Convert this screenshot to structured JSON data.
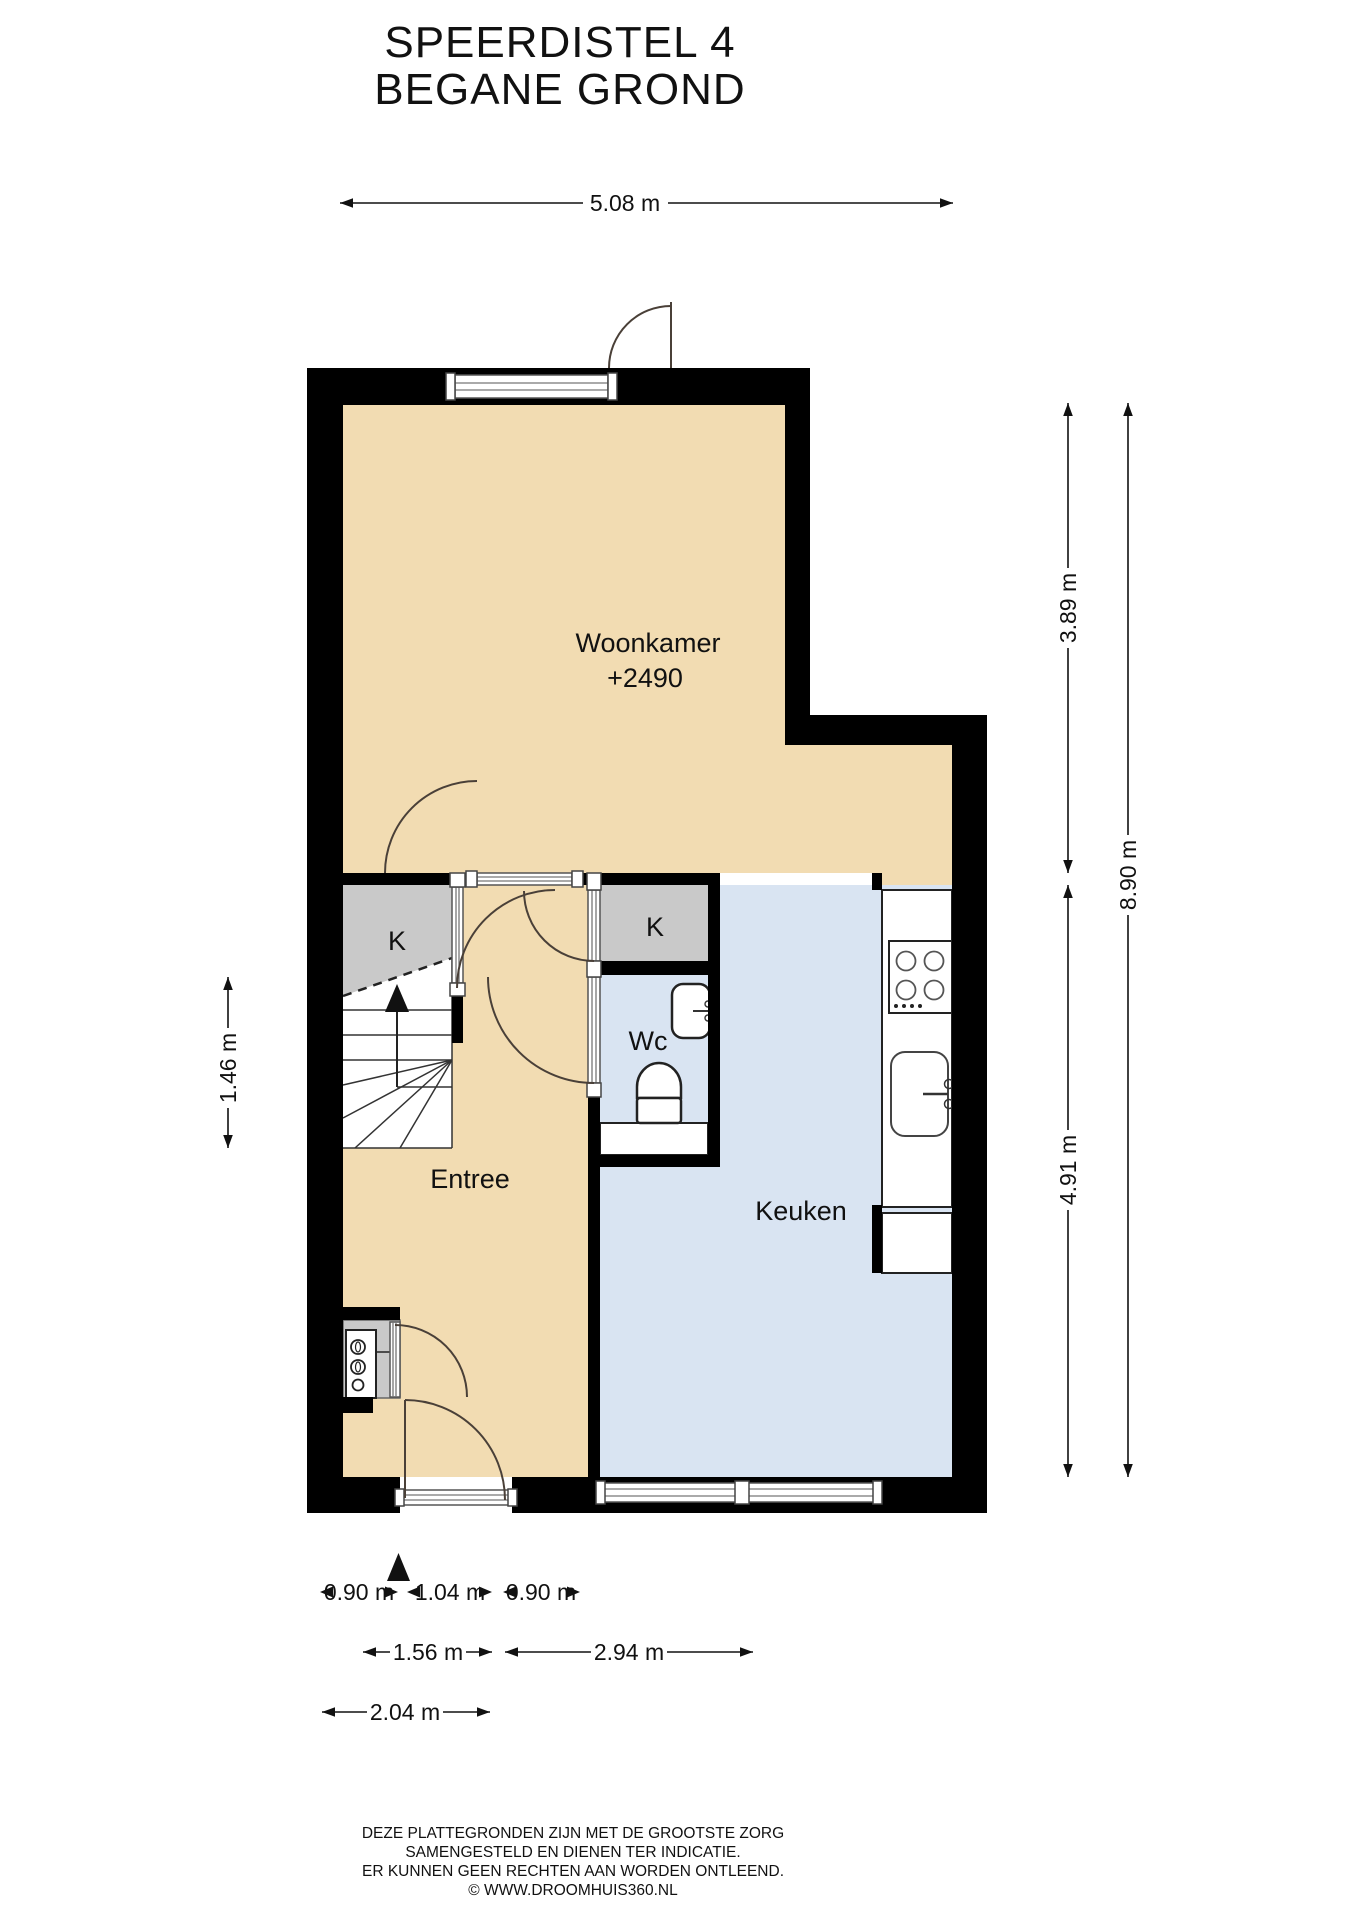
{
  "title": {
    "line1": "SPEERDISTEL 4",
    "line2": "BEGANE GROND"
  },
  "rooms": {
    "woonkamer": {
      "label": "Woonkamer",
      "level": "+2490"
    },
    "entree": {
      "label": "Entree"
    },
    "keuken": {
      "label": "Keuken"
    },
    "wc": {
      "label": "Wc"
    },
    "closet_left": {
      "label": "K"
    },
    "closet_right": {
      "label": "K"
    }
  },
  "dimensions": {
    "top_width": "5.08 m",
    "right_upper": "3.89 m",
    "right_total": "8.90 m",
    "right_lower": "4.91 m",
    "left_stairs": "1.46 m",
    "bottom_row1": [
      "0.90 m",
      "1.04 m",
      "0.90 m"
    ],
    "bottom_row2": [
      "1.56 m",
      "2.94 m"
    ],
    "bottom_row3": [
      "2.04 m"
    ]
  },
  "footer": {
    "lines": [
      "DEZE PLATTEGRONDEN ZIJN MET DE GROOTSTE ZORG",
      "SAMENGESTELD EN DIENEN TER INDICATIE.",
      "ER KUNNEN GEEN RECHTEN AAN WORDEN ONTLEEND.",
      "© WWW.DROOMHUIS360.NL"
    ]
  },
  "colors": {
    "wall": "#000000",
    "woonkamer_floor": "#F2DCB2",
    "keuken_floor": "#D9E4F2",
    "closet_fill": "#C9C9C9",
    "page_background": "#FFFFFF",
    "door_arc": "#4A4038"
  }
}
